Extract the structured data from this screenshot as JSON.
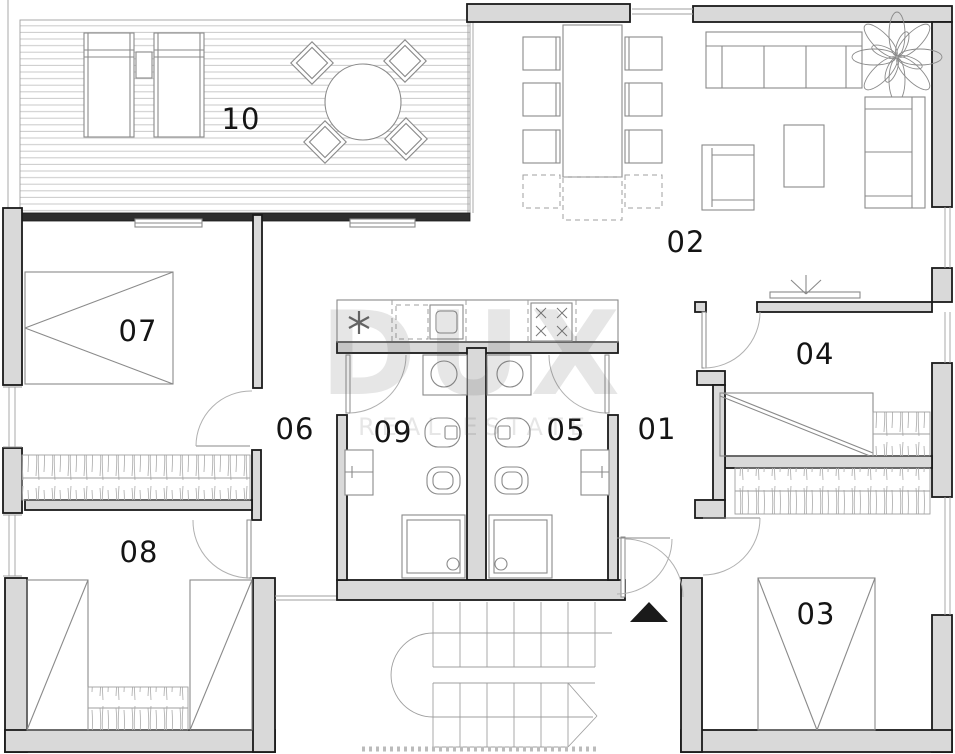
{
  "floorplan": {
    "watermark": {
      "brand": "DUX",
      "subtitle": "REAL ESTATE"
    },
    "rooms": [
      {
        "number": "10",
        "cx": 241,
        "cy": 119
      },
      {
        "number": "02",
        "cx": 686,
        "cy": 242
      },
      {
        "number": "07",
        "cx": 138,
        "cy": 331
      },
      {
        "number": "06",
        "cx": 295,
        "cy": 429
      },
      {
        "number": "09",
        "cx": 393,
        "cy": 432
      },
      {
        "number": "05",
        "cx": 566,
        "cy": 430
      },
      {
        "number": "01",
        "cx": 657,
        "cy": 429
      },
      {
        "number": "04",
        "cx": 815,
        "cy": 354
      },
      {
        "number": "08",
        "cx": 139,
        "cy": 552
      },
      {
        "number": "03",
        "cx": 816,
        "cy": 614
      }
    ],
    "colors": {
      "wall_fill": "#d9d9d9",
      "wall_stroke": "#1a1a1a",
      "furniture_line": "#8a8a8a",
      "label": "#141414",
      "watermark": "rgba(90,90,90,0.15)",
      "entrance_marker": "#1a1a1a"
    }
  }
}
